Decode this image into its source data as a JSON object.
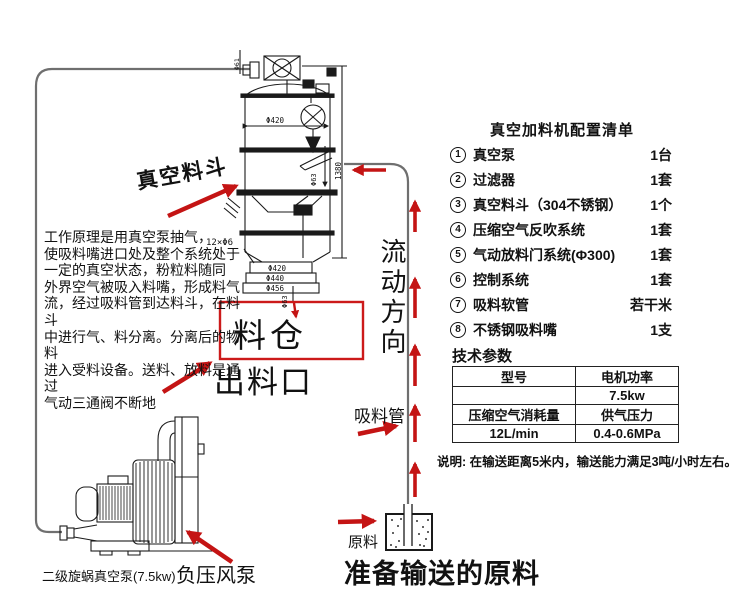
{
  "colors": {
    "arrow_red": "#c41414",
    "line_black": "#1a1a1a",
    "pipe_gray": "#6f6f6f",
    "box_red": "#cc1a1a"
  },
  "drawing": {
    "hopper_label": "真空料斗",
    "bin_label": "料仓",
    "outlet_label": "出料口",
    "flow_direction_label": "流动方向",
    "suction_pipe_label": "吸料管",
    "raw_material_label": "原料",
    "ready_material_label": "准备输送的原料",
    "pump_model_label": "二级旋蜗真空泵(7.5kw)",
    "negative_pressure_pump_label": "负压风泵",
    "principle_lines": [
      "工作原理是用真空泵抽气，",
      "使吸料嘴进口处及整个系统处于",
      "一定的真空状态，粉粒料随同",
      "外界空气被吸入料嘴，形成料气",
      "流，经过吸料管到达料斗，在料斗",
      "中进行气、料分离。分离后的物料",
      "进入受料设备。送料、放料是通过",
      "气动三通阀不断地"
    ],
    "dims": {
      "body_diameter": "Φ420",
      "flange_d1": "Φ420",
      "flange_d2": "Φ440",
      "flange_d3": "Φ456",
      "bolt_circle": "12×Φ6",
      "total_height": "1380",
      "inlet_diameter": "Φ63",
      "spout_diameter": "Φ63",
      "top_port": "Φ61"
    }
  },
  "panel": {
    "list_title": "真空加料机配置清单",
    "items": [
      {
        "num": "1",
        "label": "真空泵",
        "qty": "1台"
      },
      {
        "num": "2",
        "label": "过滤器",
        "qty": "1套"
      },
      {
        "num": "3",
        "label": "真空料斗（304不锈钢）",
        "qty": "1个"
      },
      {
        "num": "4",
        "label": "压缩空气反吹系统",
        "qty": "1套"
      },
      {
        "num": "5",
        "label": "气动放料门系统(Φ300)",
        "qty": "1套"
      },
      {
        "num": "6",
        "label": "控制系统",
        "qty": "1套"
      },
      {
        "num": "7",
        "label": "吸料软管",
        "qty": "若干米"
      },
      {
        "num": "8",
        "label": "不锈钢吸料嘴",
        "qty": "1支"
      }
    ],
    "params_title": "技术参数",
    "table_rows": [
      {
        "c1": "型号",
        "c2": "电机功率"
      },
      {
        "c1": "",
        "c2": "7.5kw"
      },
      {
        "c1": "压缩空气消耗量",
        "c2": "供气压力"
      },
      {
        "c1": "12L/min",
        "c2": "0.4-0.6MPa"
      }
    ],
    "note": "说明: 在输送距离5米内，输送能力满足3吨/小时左右。"
  }
}
